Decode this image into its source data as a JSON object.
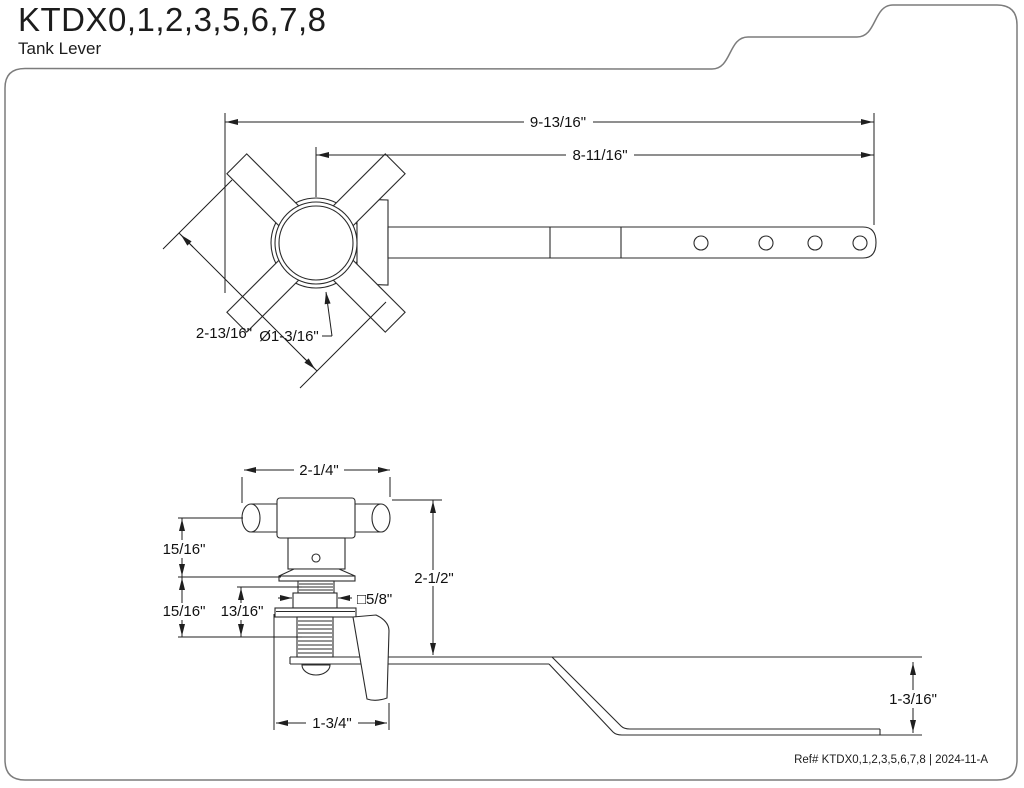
{
  "header": {
    "title": "KTDX0,1,2,3,5,6,7,8",
    "subtitle": "Tank Lever"
  },
  "top_view": {
    "dims": {
      "overall_length": "9-13/16\"",
      "arm_to_center": "8-11/16\"",
      "handle_diagonal": "2-13/16\"",
      "knob_diameter": "Ø1-3/16\""
    }
  },
  "side_view": {
    "dims": {
      "handle_width": "2-1/4\"",
      "upper_offset": "15/16\"",
      "lower_offset": "15/16\"",
      "thread_length": "13/16\"",
      "square_shank": "□5/8\"",
      "overall_height": "2-1/2\"",
      "base_length": "1-3/4\"",
      "arm_drop": "1-3/16\""
    }
  },
  "footer": {
    "ref": "Ref# KTDX0,1,2,3,5,6,7,8 | 2024-11-A"
  },
  "colors": {
    "line": "#2b2b2b",
    "border": "#7c7c7c"
  }
}
